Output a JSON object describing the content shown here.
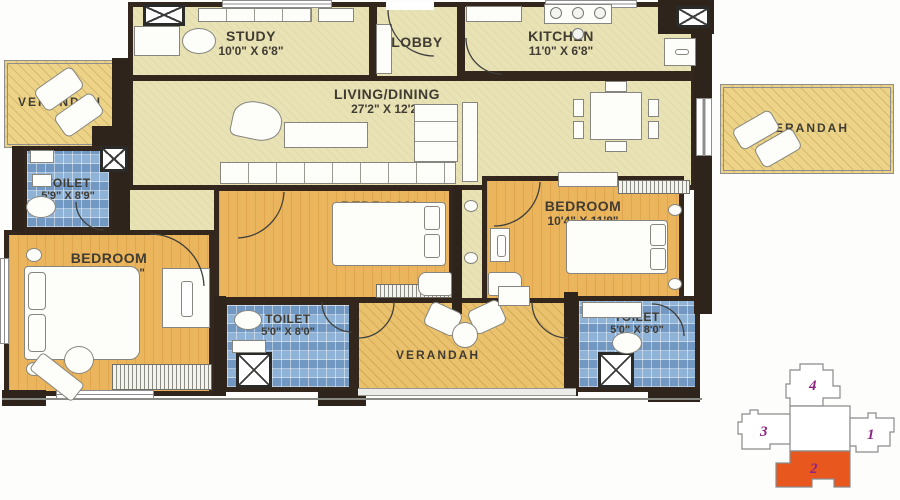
{
  "rooms": {
    "study": {
      "label": "STUDY",
      "dim": "10'0\" X 6'8\""
    },
    "lobby": {
      "label": "LOBBY"
    },
    "kitchen": {
      "label": "KITCHEN",
      "dim": "11'0\" X 6'8\""
    },
    "living": {
      "label": "LIVING/DINING",
      "dim": "27'2\" X 12'2\""
    },
    "verandah_left": {
      "label": "VERANDAH"
    },
    "verandah_right": {
      "label": "VERANDAH"
    },
    "verandah_bottom": {
      "label": "VERANDAH"
    },
    "toilet_left": {
      "label": "TOILET",
      "dim": "5'9\" X 8'9\""
    },
    "toilet_mid": {
      "label": "TOILET",
      "dim": "5'0\" X 8'0\""
    },
    "toilet_right": {
      "label": "TOILET",
      "dim": "5'0\" X 8'0\""
    },
    "bedroom_left": {
      "label": "BEDROOM",
      "dim": "10'2\" X 15'9\""
    },
    "bedroom_mid": {
      "label": "BEDROOM",
      "dim": "12'5\" X 11'8\""
    },
    "bedroom_right": {
      "label": "BEDROOM",
      "dim": "10'4\" X 11'8\""
    }
  },
  "keyplan": {
    "unit1": "1",
    "unit2": "2",
    "unit3": "3",
    "unit4": "4",
    "highlighted_unit": "2",
    "highlight_color": "#e8571d",
    "number_color": "#8d2484"
  },
  "colors": {
    "wall": "#32261d",
    "floor_main": "#e8e2b5",
    "floor_bedroom": "#eab55c",
    "floor_toilet": "#8fb3d7",
    "floor_verandah": "#ecd387",
    "floor_verandah_bottom": "#eac26e"
  }
}
